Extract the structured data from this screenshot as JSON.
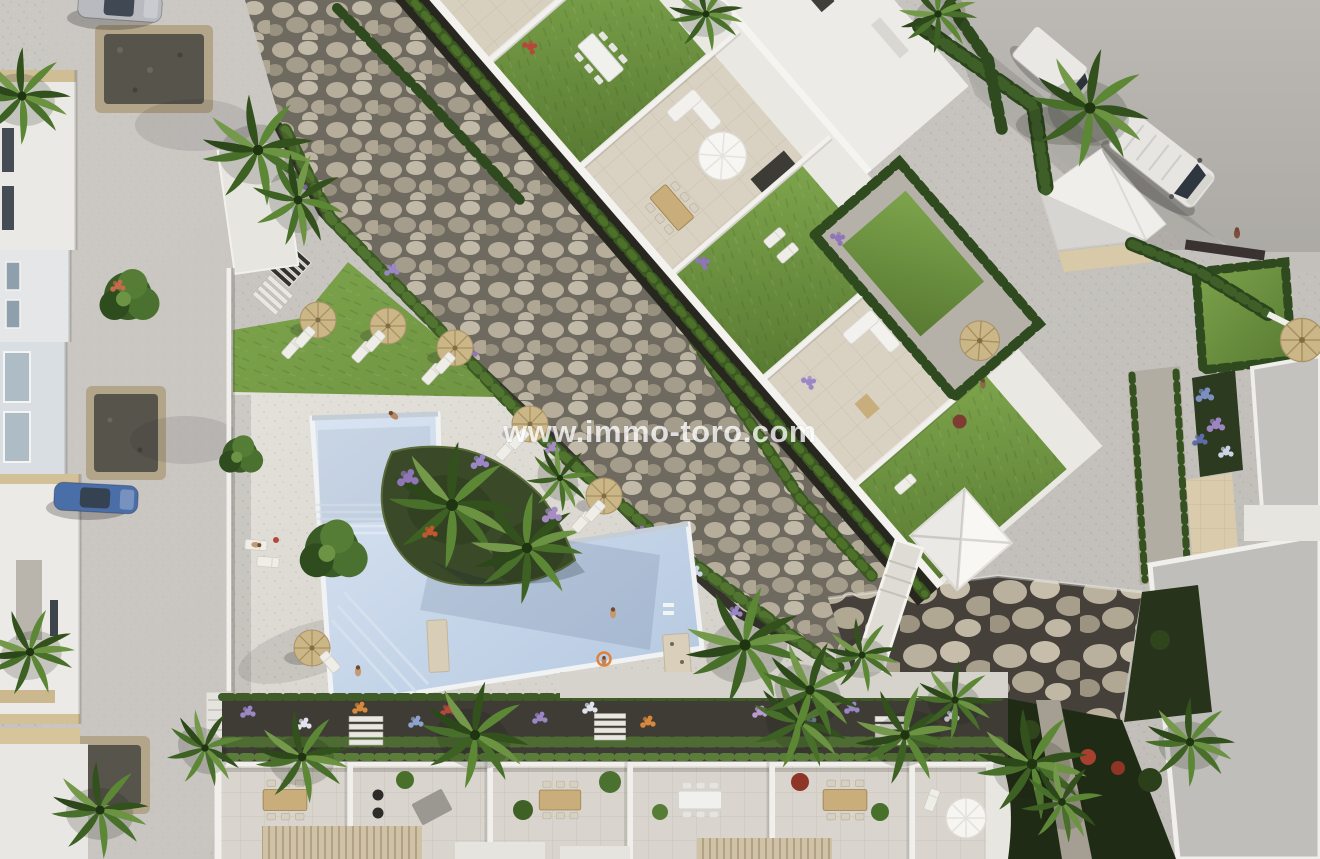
{
  "watermark": {
    "text": "www.immo-toro.com",
    "color": "#ffffff",
    "opacity": 0.78
  },
  "scene": {
    "type": "aerial-3d-architectural-render",
    "subject": "top-down view of a residential complex: communal pool with sun deck, rooftop terraces of a white apartment building, townhouse patios, streets with cars and vans, cobble-stone dry river, palm trees and flower beds",
    "palette": {
      "pavement": "#c7c4bf",
      "road": "#b4b1ac",
      "deck": "#dcd9d2",
      "pool_water": "#c8d9ea",
      "pool_shade": "#a9c0d8",
      "lawn": "#6b8e3f",
      "stones": "#b3aa99",
      "stone_bed": "#6f6a60",
      "dark_path": "#272720",
      "hedge": "#3a5822",
      "palm": "#4c7026",
      "building_white": "#eae8e3",
      "terrace_tile": "#d8d0bf",
      "parasol_straw": "#cbb687",
      "flower_purple": "#8f76b8",
      "flower_blue": "#8fa3cf",
      "flower_red": "#b5483a",
      "van_white": "#e6e5e2",
      "car_blue": "#4a6ea8",
      "car_silver": "#b9bac0",
      "gravel_dark": "#55524b",
      "vegetation_dark": "#202b15"
    },
    "elements": [
      "swimming-pool",
      "pool-deck",
      "communal-lawn",
      "stone-river",
      "retaining-rock-wall",
      "main-apartment-building",
      "rooftop-terraces",
      "pyramid-skylight",
      "courtyard-garden",
      "townhouse-terraces",
      "garden-flower-strip",
      "entrance-stairs",
      "street-left",
      "road-top-right",
      "white-van",
      "box-van",
      "silver-car",
      "blue-car",
      "palm-trees",
      "straw-parasols",
      "sun-loungers",
      "swimmers",
      "pedestrians"
    ]
  }
}
